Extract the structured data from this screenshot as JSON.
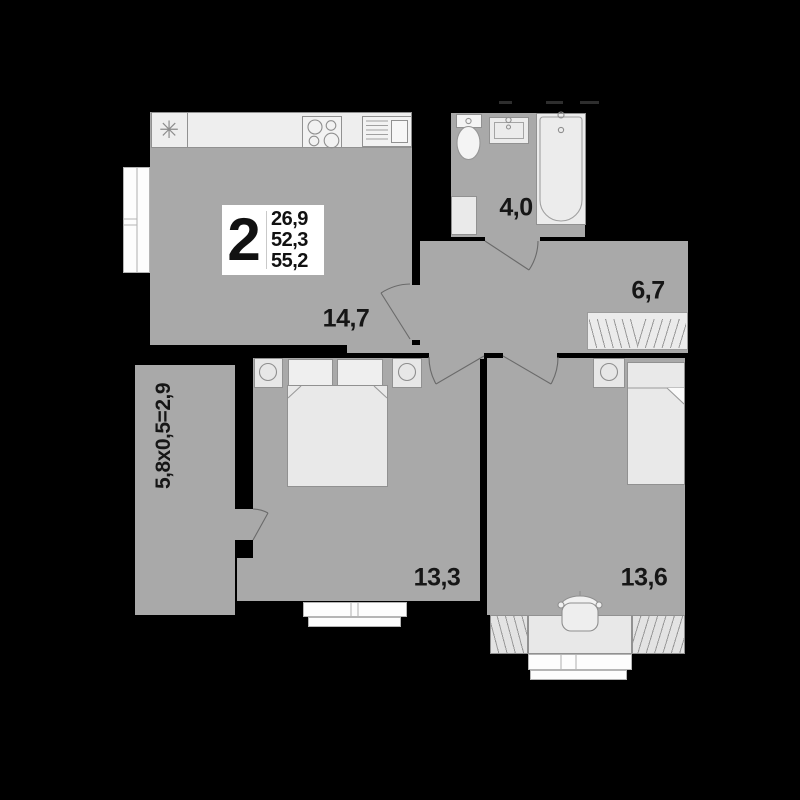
{
  "plan": {
    "info": {
      "rooms_count": "2",
      "area_living": "26,9",
      "area_main": "52,3",
      "area_total": "55,2"
    },
    "labels": {
      "kitchen_living": "14,7",
      "bathroom": "4,0",
      "hallway": "6,7",
      "bedroom1": "13,3",
      "bedroom2": "13,6",
      "balcony_formula": "5,8х0,5=2,9"
    },
    "icons": {
      "refrigerator_glyph": "✳"
    },
    "colors": {
      "background": "#000000",
      "room_fill": "#a9a9a9",
      "furniture_fill": "#ececec",
      "window_fill": "#fdfdfd",
      "outline": "#8f8f8f",
      "label_text": "#161616",
      "info_box_bg": "#ffffff"
    }
  }
}
